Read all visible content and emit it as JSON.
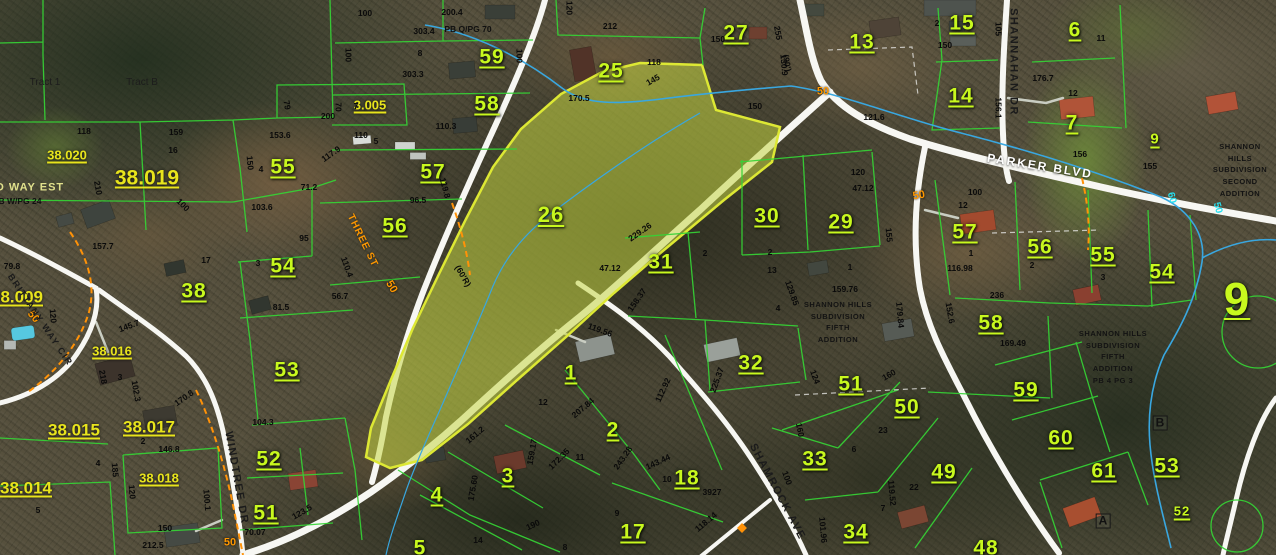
{
  "map": {
    "highlighted_parcel": "26",
    "colors": {
      "parcel_line": "#35d435",
      "parcel_label": "#c8f81e",
      "sheet_label": "#e8e41c",
      "highlight_fill": "rgba(196,214,66,0.55)",
      "highlight_stroke": "#dde834",
      "road": "#f7f7f3",
      "stream": "#39a7e0",
      "utility_line": "#ff9208",
      "dimension_text": "#0a0a0a"
    },
    "streets": [
      {
        "t": "PARKER BLVD",
        "x": 1040,
        "y": 166,
        "r": 9,
        "c": "street-white"
      },
      {
        "t": "SHANNAHAN DR",
        "x": 1013,
        "y": 62,
        "r": 90,
        "c": "street-dark"
      },
      {
        "t": "SHAMROCK AVE",
        "x": 777,
        "y": 492,
        "r": 62,
        "c": "street-dark"
      },
      {
        "t": "WINDTREE DR",
        "x": 236,
        "y": 478,
        "r": 80,
        "c": "street-dark"
      },
      {
        "t": "BRITTANY WAY CIR",
        "x": 40,
        "y": 320,
        "r": 56,
        "c": "street-dark",
        "s": 9
      },
      {
        "t": "THREE ST",
        "x": 362,
        "y": 241,
        "r": 64,
        "c": "street-orange"
      }
    ],
    "parcel_labels": [
      {
        "t": "59",
        "x": 492,
        "y": 57
      },
      {
        "t": "58",
        "x": 487,
        "y": 104
      },
      {
        "t": "55",
        "x": 283,
        "y": 167
      },
      {
        "t": "57",
        "x": 433,
        "y": 172
      },
      {
        "t": "56",
        "x": 395,
        "y": 226
      },
      {
        "t": "54",
        "x": 283,
        "y": 266
      },
      {
        "t": "38",
        "x": 194,
        "y": 291
      },
      {
        "t": "53",
        "x": 287,
        "y": 370
      },
      {
        "t": "52",
        "x": 269,
        "y": 459
      },
      {
        "t": "51",
        "x": 266,
        "y": 513
      },
      {
        "t": "25",
        "x": 611,
        "y": 71
      },
      {
        "t": "26",
        "x": 551,
        "y": 215,
        "s": 22
      },
      {
        "t": "27",
        "x": 736,
        "y": 33
      },
      {
        "t": "13",
        "x": 862,
        "y": 42
      },
      {
        "t": "15",
        "x": 962,
        "y": 23
      },
      {
        "t": "14",
        "x": 961,
        "y": 96
      },
      {
        "t": "6",
        "x": 1075,
        "y": 30
      },
      {
        "t": "7",
        "x": 1072,
        "y": 123
      },
      {
        "t": "9",
        "x": 1155,
        "y": 139,
        "s": 15
      },
      {
        "t": "30",
        "x": 767,
        "y": 216
      },
      {
        "t": "29",
        "x": 841,
        "y": 222
      },
      {
        "t": "31",
        "x": 661,
        "y": 262
      },
      {
        "t": "32",
        "x": 751,
        "y": 363
      },
      {
        "t": "1",
        "x": 571,
        "y": 373
      },
      {
        "t": "2",
        "x": 613,
        "y": 430
      },
      {
        "t": "3",
        "x": 508,
        "y": 476
      },
      {
        "t": "4",
        "x": 437,
        "y": 495
      },
      {
        "t": "5",
        "x": 420,
        "y": 548
      },
      {
        "t": "17",
        "x": 633,
        "y": 532
      },
      {
        "t": "18",
        "x": 687,
        "y": 478
      },
      {
        "t": "33",
        "x": 815,
        "y": 459
      },
      {
        "t": "34",
        "x": 856,
        "y": 532
      },
      {
        "t": "51",
        "x": 851,
        "y": 384
      },
      {
        "t": "50",
        "x": 907,
        "y": 407
      },
      {
        "t": "49",
        "x": 944,
        "y": 472
      },
      {
        "t": "48",
        "x": 986,
        "y": 548
      },
      {
        "t": "59",
        "x": 1026,
        "y": 390
      },
      {
        "t": "60",
        "x": 1061,
        "y": 438
      },
      {
        "t": "61",
        "x": 1104,
        "y": 471
      },
      {
        "t": "53",
        "x": 1167,
        "y": 466
      },
      {
        "t": "52",
        "x": 1182,
        "y": 511,
        "s": 13
      },
      {
        "t": "57",
        "x": 965,
        "y": 232
      },
      {
        "t": "56",
        "x": 1040,
        "y": 247
      },
      {
        "t": "55",
        "x": 1103,
        "y": 255
      },
      {
        "t": "54",
        "x": 1162,
        "y": 272
      },
      {
        "t": "58",
        "x": 991,
        "y": 323
      },
      {
        "t": "9",
        "x": 1237,
        "y": 299,
        "s": 46
      }
    ],
    "sheet_labels": [
      {
        "t": "38.020",
        "x": 67,
        "y": 155
      },
      {
        "t": "38.019",
        "x": 147,
        "y": 178,
        "s": 21
      },
      {
        "t": "3.005",
        "x": 370,
        "y": 105
      },
      {
        "t": "38.009",
        "x": 17,
        "y": 297,
        "s": 17
      },
      {
        "t": "38.016",
        "x": 112,
        "y": 351
      },
      {
        "t": "38.015",
        "x": 74,
        "y": 430,
        "s": 17
      },
      {
        "t": "38.017",
        "x": 149,
        "y": 427,
        "s": 17
      },
      {
        "t": "38.018",
        "x": 159,
        "y": 478
      },
      {
        "t": "38.014",
        "x": 26,
        "y": 488,
        "s": 17
      }
    ],
    "road_numbers": [
      {
        "t": "50",
        "x": 823,
        "y": 92,
        "c": "rn-orange"
      },
      {
        "t": "50",
        "x": 919,
        "y": 196,
        "r": -10,
        "c": "rn-orange"
      },
      {
        "t": "50",
        "x": 33,
        "y": 317,
        "r": 50,
        "c": "rn-orange"
      },
      {
        "t": "50",
        "x": 230,
        "y": 543,
        "c": "rn-orange"
      },
      {
        "t": "50",
        "x": 391,
        "y": 287,
        "r": 60,
        "c": "rn-orange"
      },
      {
        "t": "60",
        "x": 1171,
        "y": 198,
        "r": 75,
        "c": "rn-cyan"
      },
      {
        "t": "50",
        "x": 1217,
        "y": 208,
        "r": 75,
        "c": "rn-cyan"
      }
    ],
    "plats": [
      {
        "t": "PB Q/PG 70",
        "x": 468,
        "y": 29
      },
      {
        "t": "B W/PG 24",
        "x": 20,
        "y": 201
      },
      {
        "t": "D WAY EST",
        "x": 30,
        "y": 188,
        "c": "pale"
      }
    ],
    "tracts": [
      {
        "t": "Tract 1",
        "x": 45,
        "y": 83
      },
      {
        "t": "Tract B",
        "x": 142,
        "y": 83
      }
    ],
    "markers": [
      {
        "t": "A",
        "x": 1103,
        "y": 521
      },
      {
        "t": "B",
        "x": 1160,
        "y": 423
      }
    ],
    "text_blocks": [
      {
        "x": 838,
        "y": 322,
        "lines": [
          "SHANNON HILLS",
          "SUBDIVISION",
          "FIFTH",
          "ADDITION"
        ]
      },
      {
        "x": 1113,
        "y": 357,
        "lines": [
          "SHANNON HILLS",
          "SUBDIVISION",
          "FIFTH",
          "ADDITION",
          "PB 4 PG 3"
        ]
      },
      {
        "x": 1240,
        "y": 170,
        "lines": [
          "SHANNON HILLS",
          "SUBDIVISION",
          "SECOND",
          "ADDITION"
        ]
      }
    ],
    "dimensions": [
      {
        "t": "100",
        "x": 365,
        "y": 13
      },
      {
        "t": "200.4",
        "x": 452,
        "y": 12
      },
      {
        "t": "303.4",
        "x": 424,
        "y": 31
      },
      {
        "t": "8",
        "x": 420,
        "y": 53
      },
      {
        "t": "100",
        "x": 348,
        "y": 55,
        "r": 90
      },
      {
        "t": "100",
        "x": 519,
        "y": 56,
        "r": 90
      },
      {
        "t": "303.3",
        "x": 413,
        "y": 74
      },
      {
        "t": "70",
        "x": 338,
        "y": 107,
        "r": 90
      },
      {
        "t": "7",
        "x": 356,
        "y": 106
      },
      {
        "t": "110.3",
        "x": 446,
        "y": 126
      },
      {
        "t": "200",
        "x": 328,
        "y": 116
      },
      {
        "t": "79",
        "x": 287,
        "y": 105,
        "r": 80
      },
      {
        "t": "110",
        "x": 361,
        "y": 135
      },
      {
        "t": "5",
        "x": 376,
        "y": 141
      },
      {
        "t": "117.9",
        "x": 331,
        "y": 154,
        "r": -35
      },
      {
        "t": "153.6",
        "x": 280,
        "y": 135
      },
      {
        "t": "159",
        "x": 176,
        "y": 132
      },
      {
        "t": "16",
        "x": 173,
        "y": 150
      },
      {
        "t": "118",
        "x": 84,
        "y": 131
      },
      {
        "t": "4",
        "x": 261,
        "y": 169
      },
      {
        "t": "150",
        "x": 250,
        "y": 163,
        "r": 85
      },
      {
        "t": "212",
        "x": 610,
        "y": 26
      },
      {
        "t": "120",
        "x": 569,
        "y": 8,
        "r": 90
      },
      {
        "t": "118",
        "x": 654,
        "y": 62
      },
      {
        "t": "145",
        "x": 653,
        "y": 80,
        "r": -30
      },
      {
        "t": "150",
        "x": 718,
        "y": 39
      },
      {
        "t": "150",
        "x": 755,
        "y": 106
      },
      {
        "t": "255",
        "x": 778,
        "y": 33,
        "r": 80
      },
      {
        "t": "(90')",
        "x": 787,
        "y": 63,
        "r": 80
      },
      {
        "t": "170.5",
        "x": 579,
        "y": 98
      },
      {
        "t": "2",
        "x": 937,
        "y": 23
      },
      {
        "t": "11",
        "x": 1101,
        "y": 38
      },
      {
        "t": "12",
        "x": 1073,
        "y": 93
      },
      {
        "t": "176.7",
        "x": 1043,
        "y": 78
      },
      {
        "t": "105",
        "x": 998,
        "y": 29,
        "r": 90
      },
      {
        "t": "156.1",
        "x": 998,
        "y": 108,
        "r": 90
      },
      {
        "t": "121.6",
        "x": 874,
        "y": 117
      },
      {
        "t": "130.9",
        "x": 784,
        "y": 65,
        "r": 85
      },
      {
        "t": "120",
        "x": 858,
        "y": 172
      },
      {
        "t": "150",
        "x": 945,
        "y": 45
      },
      {
        "t": "155",
        "x": 1150,
        "y": 166
      },
      {
        "t": "156",
        "x": 1080,
        "y": 154
      },
      {
        "t": "100",
        "x": 975,
        "y": 192
      },
      {
        "t": "12",
        "x": 963,
        "y": 205
      },
      {
        "t": "1",
        "x": 971,
        "y": 253
      },
      {
        "t": "2",
        "x": 1032,
        "y": 265
      },
      {
        "t": "3",
        "x": 1103,
        "y": 277
      },
      {
        "t": "116.98",
        "x": 960,
        "y": 268
      },
      {
        "t": "236",
        "x": 997,
        "y": 295
      },
      {
        "t": "152.6",
        "x": 950,
        "y": 313,
        "r": 80
      },
      {
        "t": "169.49",
        "x": 1013,
        "y": 343
      },
      {
        "t": "119.8",
        "x": 445,
        "y": 188,
        "r": 75
      },
      {
        "t": "96.5",
        "x": 418,
        "y": 200
      },
      {
        "t": "(60'R)",
        "x": 463,
        "y": 276,
        "r": 60
      },
      {
        "t": "229.26",
        "x": 640,
        "y": 232,
        "r": -35
      },
      {
        "t": "47.12",
        "x": 610,
        "y": 268
      },
      {
        "t": "2",
        "x": 705,
        "y": 253
      },
      {
        "t": "2",
        "x": 770,
        "y": 252
      },
      {
        "t": "13",
        "x": 772,
        "y": 270
      },
      {
        "t": "47.12",
        "x": 863,
        "y": 188
      },
      {
        "t": "155",
        "x": 889,
        "y": 235,
        "r": 85
      },
      {
        "t": "159.76",
        "x": 845,
        "y": 289
      },
      {
        "t": "129.85",
        "x": 792,
        "y": 293,
        "r": 70
      },
      {
        "t": "179.84",
        "x": 900,
        "y": 315,
        "r": 85
      },
      {
        "t": "4",
        "x": 778,
        "y": 308
      },
      {
        "t": "1",
        "x": 850,
        "y": 267
      },
      {
        "t": "124",
        "x": 815,
        "y": 377,
        "r": 70
      },
      {
        "t": "160",
        "x": 889,
        "y": 375,
        "r": -30
      },
      {
        "t": "119.56",
        "x": 600,
        "y": 330,
        "r": 20
      },
      {
        "t": "158.37",
        "x": 637,
        "y": 300,
        "r": -55
      },
      {
        "t": "112.92",
        "x": 663,
        "y": 390,
        "r": -65
      },
      {
        "t": "207.84",
        "x": 583,
        "y": 408,
        "r": -40
      },
      {
        "t": "225.37",
        "x": 717,
        "y": 380,
        "r": -70
      },
      {
        "t": "243.28",
        "x": 623,
        "y": 458,
        "r": -55
      },
      {
        "t": "143.44",
        "x": 658,
        "y": 462,
        "r": -25
      },
      {
        "t": "172.35",
        "x": 559,
        "y": 459,
        "r": -45
      },
      {
        "t": "159.17",
        "x": 532,
        "y": 452,
        "r": -80
      },
      {
        "t": "161.2",
        "x": 475,
        "y": 435,
        "r": -40
      },
      {
        "t": "12",
        "x": 543,
        "y": 402
      },
      {
        "t": "11",
        "x": 580,
        "y": 457
      },
      {
        "t": "14",
        "x": 478,
        "y": 540
      },
      {
        "t": "8",
        "x": 565,
        "y": 547
      },
      {
        "t": "9",
        "x": 617,
        "y": 513
      },
      {
        "t": "10",
        "x": 667,
        "y": 479
      },
      {
        "t": "3927",
        "x": 712,
        "y": 492
      },
      {
        "t": "118.14",
        "x": 706,
        "y": 522,
        "r": -40
      },
      {
        "t": "119.52",
        "x": 892,
        "y": 493,
        "r": 85
      },
      {
        "t": "101.96",
        "x": 823,
        "y": 530,
        "r": 85
      },
      {
        "t": "100",
        "x": 787,
        "y": 478,
        "r": 70
      },
      {
        "t": "22",
        "x": 914,
        "y": 487
      },
      {
        "t": "7",
        "x": 883,
        "y": 508
      },
      {
        "t": "175.60",
        "x": 473,
        "y": 488,
        "r": -80
      },
      {
        "t": "190",
        "x": 533,
        "y": 525,
        "r": -25
      },
      {
        "t": "210",
        "x": 98,
        "y": 188,
        "r": 80
      },
      {
        "t": "100",
        "x": 183,
        "y": 205,
        "r": 45
      },
      {
        "t": "157.7",
        "x": 103,
        "y": 246
      },
      {
        "t": "103.6",
        "x": 262,
        "y": 207
      },
      {
        "t": "71.2",
        "x": 309,
        "y": 187
      },
      {
        "t": "95",
        "x": 304,
        "y": 238
      },
      {
        "t": "17",
        "x": 206,
        "y": 260
      },
      {
        "t": "3",
        "x": 258,
        "y": 263
      },
      {
        "t": "110.4",
        "x": 347,
        "y": 267,
        "r": 70
      },
      {
        "t": "56.7",
        "x": 340,
        "y": 296
      },
      {
        "t": "81.5",
        "x": 281,
        "y": 307
      },
      {
        "t": "120",
        "x": 53,
        "y": 316,
        "r": 85
      },
      {
        "t": "79.8",
        "x": 12,
        "y": 266
      },
      {
        "t": "145.7",
        "x": 129,
        "y": 326,
        "r": -20
      },
      {
        "t": "102.3",
        "x": 136,
        "y": 391,
        "r": 80
      },
      {
        "t": "170.8",
        "x": 184,
        "y": 398,
        "r": -35
      },
      {
        "t": "218",
        "x": 103,
        "y": 377,
        "r": 80
      },
      {
        "t": "3",
        "x": 120,
        "y": 377
      },
      {
        "t": "2",
        "x": 143,
        "y": 441
      },
      {
        "t": "146.8",
        "x": 169,
        "y": 449
      },
      {
        "t": "104.3",
        "x": 263,
        "y": 422
      },
      {
        "t": "150",
        "x": 165,
        "y": 528
      },
      {
        "t": "212.5",
        "x": 153,
        "y": 545
      },
      {
        "t": "70.07",
        "x": 255,
        "y": 532
      },
      {
        "t": "123.5",
        "x": 302,
        "y": 512,
        "r": -30
      },
      {
        "t": "120",
        "x": 132,
        "y": 492,
        "r": 85
      },
      {
        "t": "185",
        "x": 115,
        "y": 470,
        "r": 85
      },
      {
        "t": "100.1",
        "x": 207,
        "y": 500,
        "r": 85
      },
      {
        "t": "5",
        "x": 38,
        "y": 510
      },
      {
        "t": "4",
        "x": 98,
        "y": 463
      },
      {
        "t": "160",
        "x": 800,
        "y": 430,
        "r": 80
      },
      {
        "t": "6",
        "x": 854,
        "y": 449
      },
      {
        "t": "23",
        "x": 883,
        "y": 430
      }
    ]
  }
}
